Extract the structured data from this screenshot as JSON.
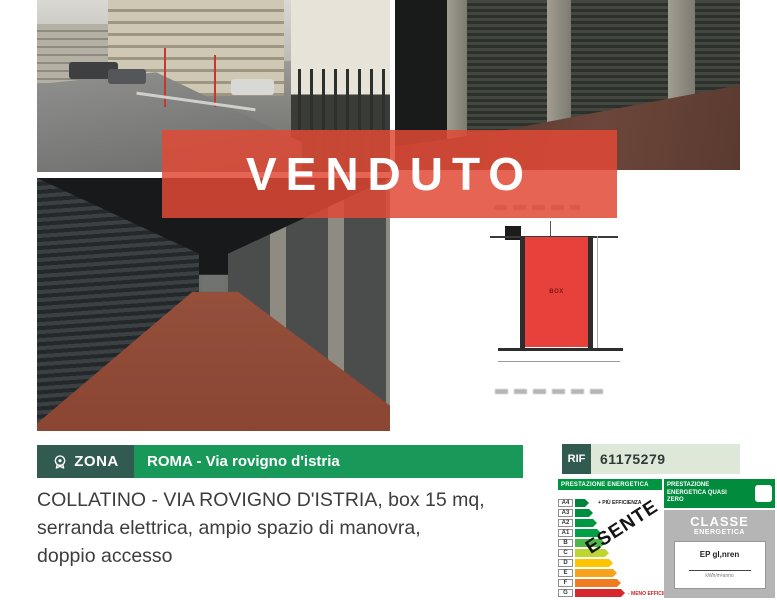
{
  "banner": {
    "label": "VENDUTO",
    "color": "#e04935"
  },
  "zona_bar": {
    "label": "ZONA",
    "value": "ROMA - Via rovigno d'istria",
    "dark_bg": "#315b50",
    "green_bg": "#18995a"
  },
  "rif": {
    "label": "RIF",
    "value": "61175279",
    "dark_bg": "#315b50",
    "light_bg": "#dde8d8"
  },
  "description": {
    "line1": "COLLATINO - VIA ROVIGNO D'ISTRIA, box 15 mq,",
    "line2": "serranda elettrica, ampio spazio di manovra,",
    "line3": "doppio accesso"
  },
  "floorplan": {
    "room_label": "BOX",
    "room_color": "#e8413c"
  },
  "energy": {
    "header": "PRESTAZIONE ENERGETICA",
    "more_label": "+ PIÙ EFFICIENZA",
    "less_label": "- MENO EFFICIENZA",
    "exempt": "ESENTE",
    "nzeb_label": "PRESTAZIONE ENERGETICA QUASI ZERO",
    "class_title": "CLASSE",
    "class_subtitle": "ENERGETICA",
    "ep_label": "EP gl,nren",
    "ep_unit": "kWh/m²anno",
    "classes": [
      {
        "label": "A4",
        "color": "#00843d",
        "width": 14
      },
      {
        "label": "A3",
        "color": "#008f40",
        "width": 18
      },
      {
        "label": "A2",
        "color": "#009743",
        "width": 22
      },
      {
        "label": "A1",
        "color": "#009f47",
        "width": 26
      },
      {
        "label": "B",
        "color": "#4fb747",
        "width": 30
      },
      {
        "label": "C",
        "color": "#bed630",
        "width": 34
      },
      {
        "label": "D",
        "color": "#fdc400",
        "width": 38
      },
      {
        "label": "E",
        "color": "#f6a31c",
        "width": 42
      },
      {
        "label": "F",
        "color": "#f07c22",
        "width": 46
      },
      {
        "label": "G",
        "color": "#d7282f",
        "width": 50
      }
    ]
  }
}
